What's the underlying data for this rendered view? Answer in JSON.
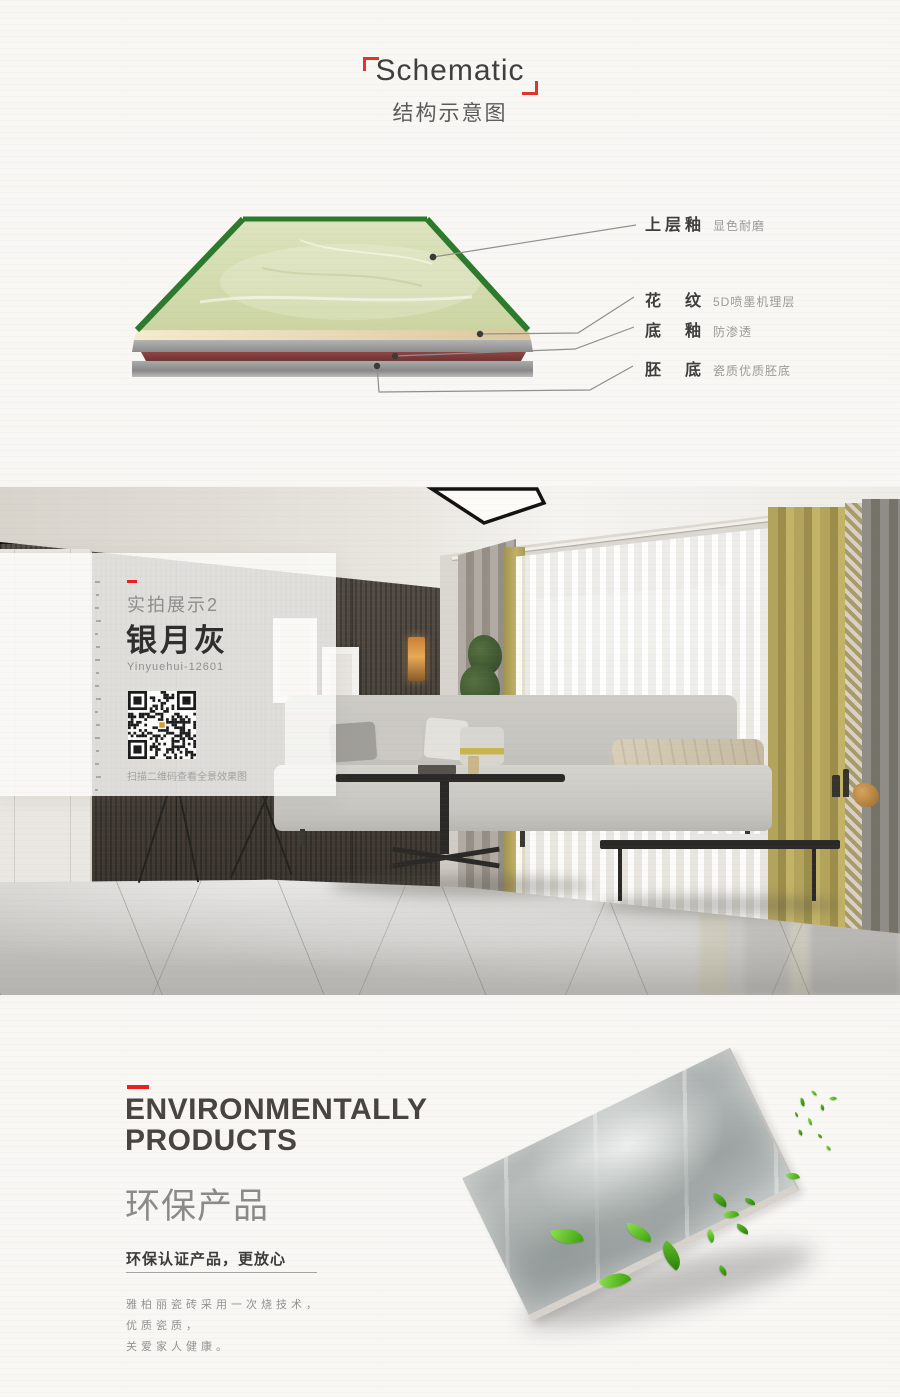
{
  "schematic": {
    "title": "Schematic",
    "subtitle": "结构示意图",
    "layers": [
      {
        "name": "上层釉",
        "desc": "显色耐磨"
      },
      {
        "name": "花　纹",
        "desc": "5D喷墨机理层"
      },
      {
        "name": "底　釉",
        "desc": "防渗透"
      },
      {
        "name": "胚　底",
        "desc": "瓷质优质胚底"
      }
    ]
  },
  "showcase": {
    "tag": "实拍展示2",
    "name": "银月灰",
    "code": "Yinyuehui-12601",
    "qr_caption": "扫描二维码查看全景效果图"
  },
  "eco": {
    "heading_line1": "ENVIRONMENTALLY",
    "heading_line2": "PRODUCTS",
    "heading_zh": "环保产品",
    "tagline": "环保认证产品，更放心",
    "body_lines": [
      "雅柏丽瓷砖采用一次烧技术，",
      "优质瓷质，",
      "关爱家人健康。"
    ]
  },
  "colors": {
    "accent_red": "#ee1c1c",
    "tile_edge_green": "#2c7a2c"
  }
}
